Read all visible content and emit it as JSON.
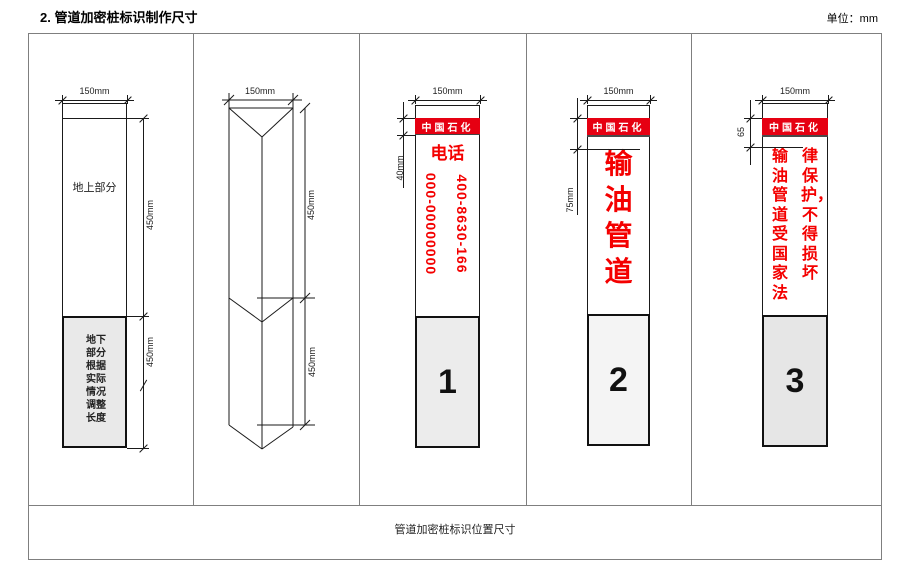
{
  "page": {
    "title": "2. 管道加密桩标识制作尺寸",
    "unit_label": "单位：mm",
    "caption": "管道加密桩标识位置尺寸"
  },
  "colors": {
    "brand_red": "#e60012",
    "sign_text_red": "#f40000",
    "underground_gray": "#e9e9e9",
    "table_border_gray": "#7f7f7f",
    "drawing_line_black": "#1a1a1a"
  },
  "panels": {
    "front_view": {
      "width_dim": "150mm",
      "above_ground_label": "地上部分",
      "above_ground_dim": "450mm",
      "underground_dim": "450mm",
      "underground_note": "地下部分根据实际情况调整长度"
    },
    "prism_view": {
      "width_dim": "150mm",
      "above_ground_dim": "450mm",
      "underground_dim": "450mm"
    },
    "sign_phone": {
      "width_dim": "150mm",
      "banner_label": "中国石化",
      "banner_height_dim": "40mm",
      "heading": "电话",
      "phone_col_left": "000-00000000",
      "phone_col_right": "400-8630-166",
      "index_number": "1"
    },
    "sign_pipeline": {
      "width_dim": "150mm",
      "banner_label": "中国石化",
      "header_height_dim": "75mm",
      "vertical_text": "输油管道",
      "index_number": "2"
    },
    "sign_legal": {
      "width_dim": "150mm",
      "banner_label": "中国石化",
      "header_height_dim": "65",
      "text_col_left": "输油管道受国家法",
      "text_col_right": "律保护，不得损坏",
      "index_number": "3"
    }
  }
}
